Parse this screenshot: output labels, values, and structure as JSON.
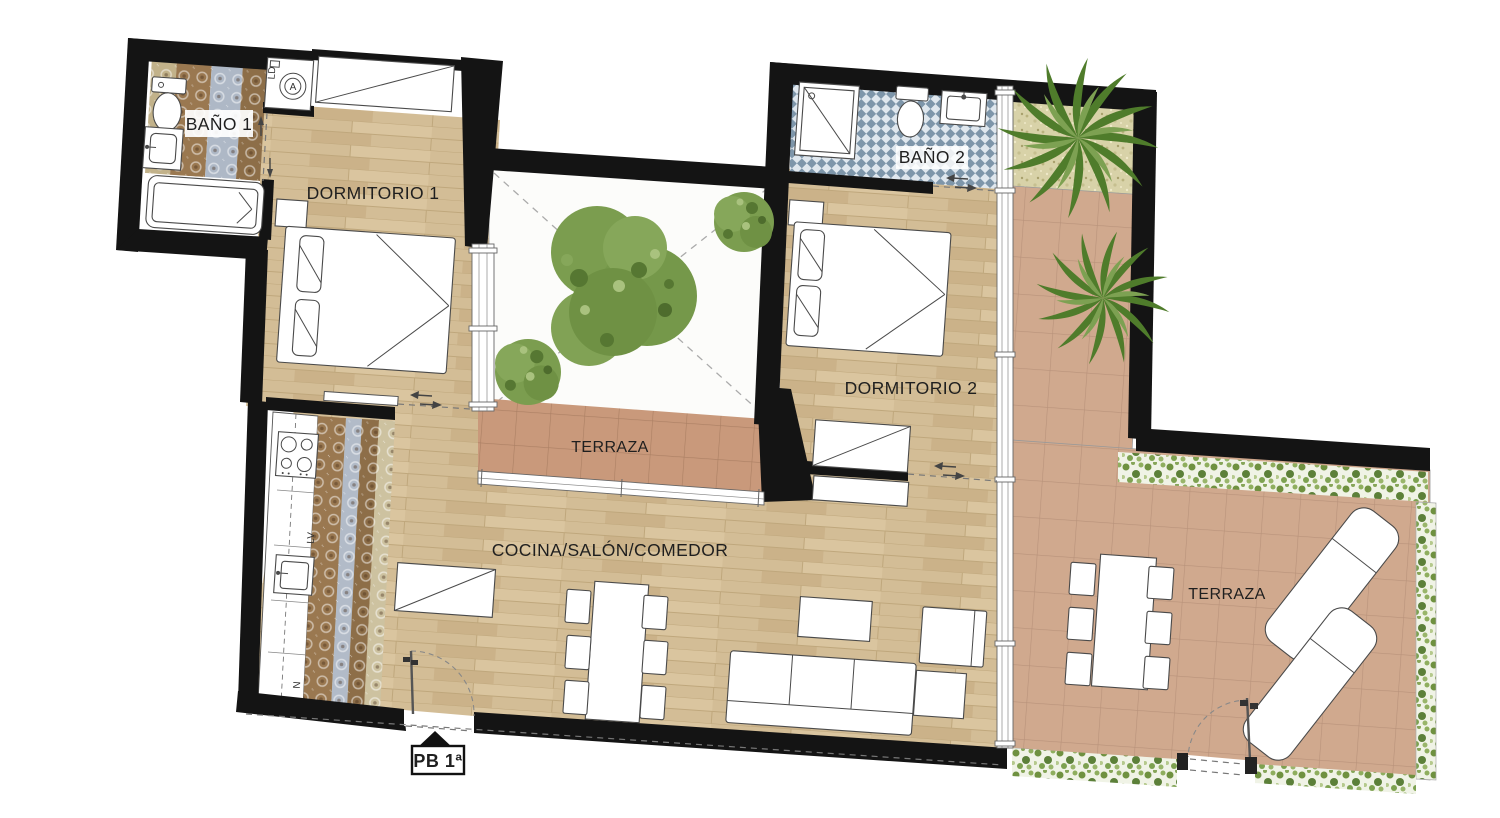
{
  "meta": {
    "drawing_type": "apartment floor plan"
  },
  "rooms": {
    "bano1": {
      "label": "BAÑO 1"
    },
    "dormitorio1": {
      "label": "DORMITORIO 1"
    },
    "bano2": {
      "label": "BAÑO 2"
    },
    "dormitorio2": {
      "label": "DORMITORIO 2"
    },
    "patio": {
      "label": "TERRAZA"
    },
    "cocina_salon_comedor": {
      "label": "COCINA/SALÓN/COMEDOR"
    },
    "terraza_right": {
      "label": "TERRAZA"
    }
  },
  "appliances": {
    "dishwasher": "LV",
    "fridge": "N",
    "laundry_closet": "LD",
    "washer_letter": "A"
  },
  "entry": {
    "label": "PB 1ª"
  },
  "colors": {
    "wall": "#141414",
    "wood_floor": "#d3bd96",
    "terrace_tile": "#d0a98e",
    "patio_strip_tile": "#c9997b",
    "bath2_checker": "#7e96aa",
    "hedge_green": "#6f9140",
    "gravel": "#d8d2a8",
    "tree_green": "#7b9d4f"
  }
}
